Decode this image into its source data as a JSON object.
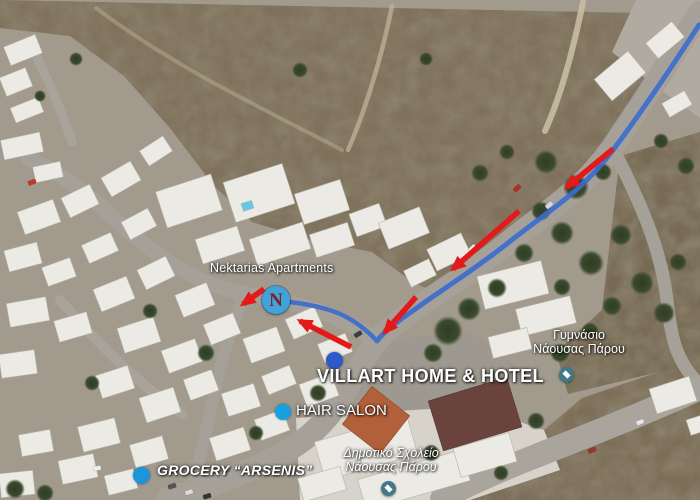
{
  "map": {
    "overlay_labels": {
      "nektarias": "Nektarias Apartments",
      "villart": "VILLART HOME & HOTEL",
      "hair_salon": "HAIR SALON",
      "grocery": "GROCERY “ARSENIS”",
      "gymnasio": {
        "line1": "Γυμνάσιο",
        "line2": "Νάουσας Πάρου"
      },
      "dimotiko": {
        "line1": "Δημοτικό Σχολείο",
        "line2": "Νάουσας Πάρου"
      }
    },
    "markers": {
      "n_letter": "N"
    },
    "colors": {
      "route": "#3a6bcf",
      "arrow": "#e41a1a",
      "n_circle": "#40a3da",
      "n_letter": "#7e1f1f",
      "villart_dot": "#2e59c8",
      "hair_dot": "#16a2e2",
      "grocery_dot": "#1d95da",
      "school_pin": "#41798a",
      "pin_tip": "#41798a"
    },
    "route": {
      "main": "M 699 25 C 666 76 640 114 613 150 C 582 192 548 211 508 243 C 471 272 440 291 421 305 C 403 318 387 328 377 341",
      "branch": "M 377 341 C 362 325 345 314 326 309 C 312 305 299 303 289 302",
      "arrows": [
        "M 613 149 L 567 187",
        "M 519 211 L 453 269",
        "M 416 297 L 385 332",
        "M 351 347 L 300 321",
        "M 264 289 L 243 304"
      ]
    }
  }
}
